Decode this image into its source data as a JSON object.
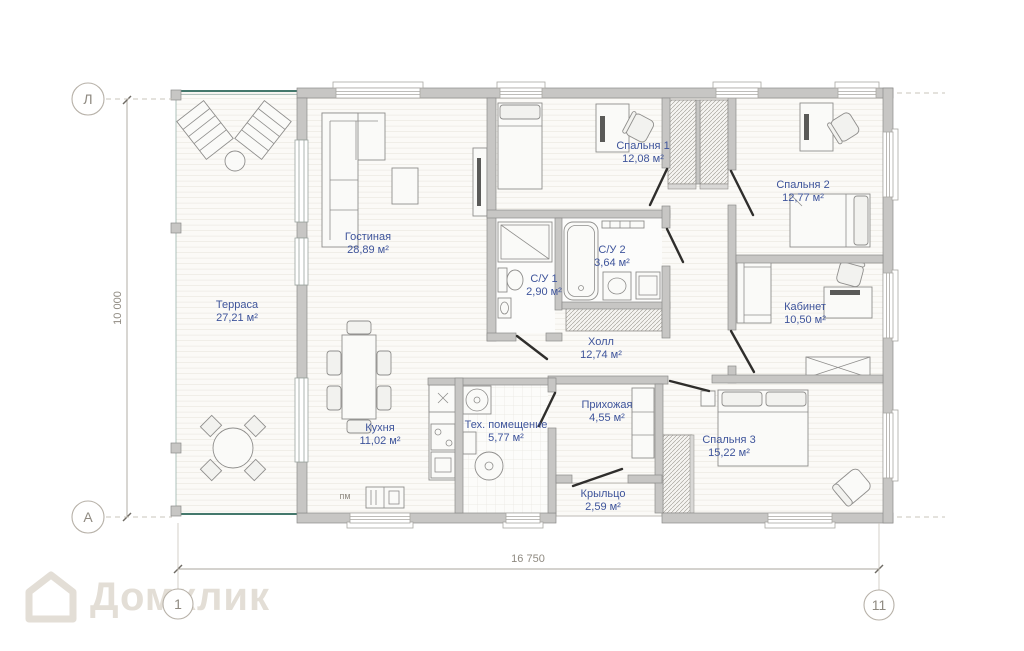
{
  "axes": {
    "row_top": "Л",
    "row_bottom": "А",
    "col_start": "1",
    "col_end": "11"
  },
  "dimensions": {
    "width": "16 750",
    "height": "10 000"
  },
  "rooms": [
    {
      "id": "terrace",
      "name": "Терраса",
      "area": "27,21 м²"
    },
    {
      "id": "living",
      "name": "Гостиная",
      "area": "28,89 м²"
    },
    {
      "id": "kitchen",
      "name": "Кухня",
      "area": "11,02 м²"
    },
    {
      "id": "tech",
      "name": "Тех. помещение",
      "area": "5,77 м²"
    },
    {
      "id": "wc1",
      "name": "С/У 1",
      "area": "2,90 м²"
    },
    {
      "id": "wc2",
      "name": "С/У 2",
      "area": "3,64 м²"
    },
    {
      "id": "bedroom1",
      "name": "Спальня 1",
      "area": "12,08 м²"
    },
    {
      "id": "hall",
      "name": "Холл",
      "area": "12,74 м²"
    },
    {
      "id": "entry",
      "name": "Прихожая",
      "area": "4,55 м²"
    },
    {
      "id": "porch",
      "name": "Крыльцо",
      "area": "2,59 м²"
    },
    {
      "id": "bedroom2",
      "name": "Спальня 2",
      "area": "12,77 м²"
    },
    {
      "id": "office",
      "name": "Кабинет",
      "area": "10,50 м²"
    },
    {
      "id": "bedroom3",
      "name": "Спальня 3",
      "area": "15,22 м²"
    }
  ],
  "labels": {
    "washer": "пм"
  },
  "watermark": {
    "text": "Домклик"
  },
  "colors": {
    "wall": "#c7c6c4",
    "room_label": "#3e549b",
    "dimension_text": "#8f8a81",
    "terrace_edge": "#44786c"
  }
}
